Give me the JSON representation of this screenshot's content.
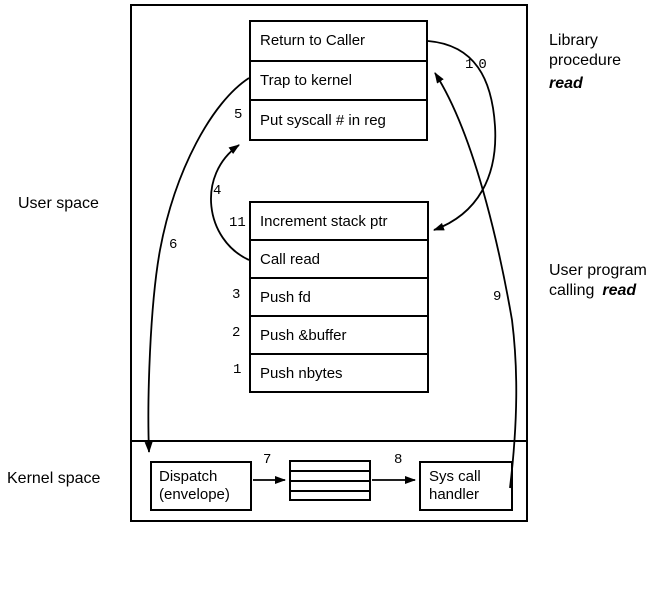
{
  "colors": {
    "ink": "#000000",
    "background": "#ffffff"
  },
  "regions": {
    "user_space": "User space",
    "kernel_space": "Kernel space"
  },
  "library_procedure": {
    "rows": [
      "Return to Caller",
      "Trap to kernel",
      "Put syscall # in reg"
    ],
    "caption": {
      "line1": "Library",
      "line2": "procedure",
      "emphasis": "read"
    }
  },
  "user_program": {
    "rows": [
      "Increment stack ptr",
      "Call read",
      "Push fd",
      "Push &buffer",
      "Push nbytes"
    ],
    "caption": {
      "line1": "User program",
      "line2": "calling",
      "emphasis": "read"
    }
  },
  "kernel": {
    "dispatch": {
      "line1": "Dispatch",
      "line2": "(envelope)"
    },
    "handler": {
      "line1": "Sys call",
      "line2": "handler"
    }
  },
  "steps": {
    "s1": "1",
    "s2": "2",
    "s3": "3",
    "s4": "4",
    "s5": "5",
    "s6": "6",
    "s7": "7",
    "s8": "8",
    "s9": "9",
    "s10": "10",
    "s11": "11"
  }
}
